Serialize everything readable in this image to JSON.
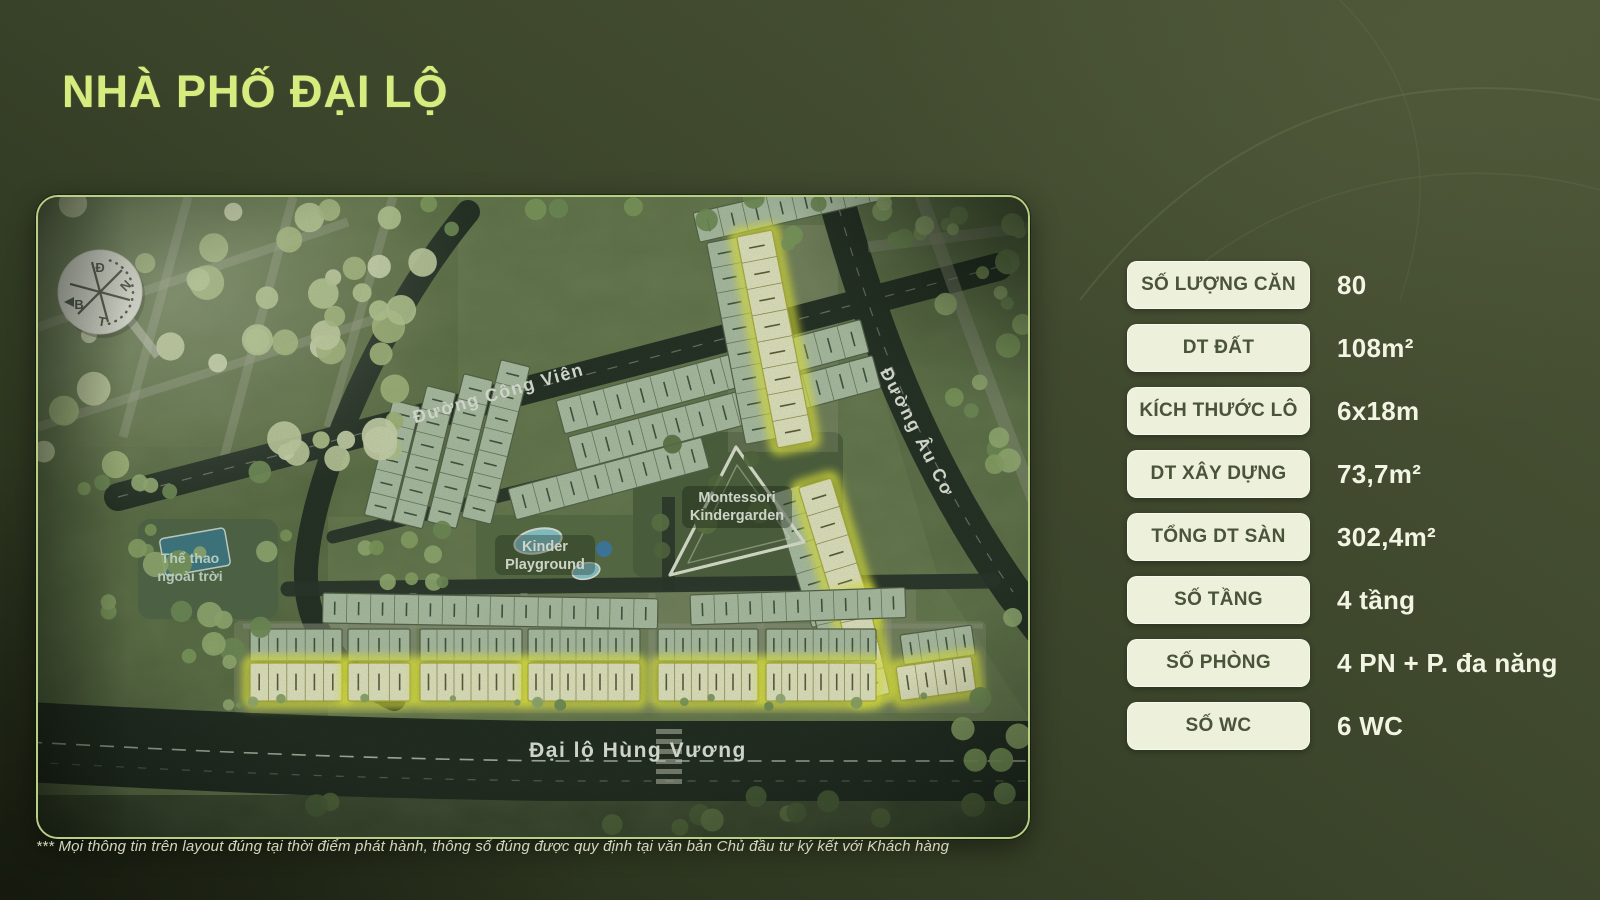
{
  "slide": {
    "title": "NHÀ PHỐ ĐẠI LỘ",
    "footnote": "*** Mọi thông tin trên layout đúng tại thời điểm phát hành, thông số đúng được quy định tại văn bản Chủ đầu tư ký kết với Khách hàng"
  },
  "specs": {
    "rows": [
      {
        "label": "SỐ LƯỢNG CĂN",
        "value": "80"
      },
      {
        "label": "DT ĐẤT",
        "value": "108m²"
      },
      {
        "label": "KÍCH THƯỚC LÔ",
        "value": "6x18m"
      },
      {
        "label": "DT XÂY DỰNG",
        "value": "73,7m²"
      },
      {
        "label": "TỔNG DT SÀN",
        "value": "302,4m²"
      },
      {
        "label": "SỐ TẦNG",
        "value": "4 tầng"
      },
      {
        "label": "SỐ PHÒNG",
        "value": "4 PN  + P. đa năng"
      },
      {
        "label": "SỐ WC",
        "value": "6 WC"
      }
    ]
  },
  "map": {
    "roads": {
      "cong_vien": "Đường Công Viên",
      "au_co": "Đường Âu Cơ",
      "hung_vuong": "Đại lộ Hùng Vương"
    },
    "landmarks": {
      "kindergarden_line1": "Montessori",
      "kindergarden_line2": "Kindergarden",
      "playground_line1": "Kinder",
      "playground_line2": "Playground",
      "sport_line1": "Thể thao",
      "sport_line2": "ngoài trời"
    },
    "compass": {
      "top": "Đ",
      "right": "N",
      "bottom": "T",
      "left": "B"
    }
  },
  "colors": {
    "title_accent": "#d6ec7f",
    "pill_bg": "#edf0da",
    "pill_text": "#4a5439",
    "value_text": "#f3f5e4",
    "highlight_lot": "#f2f83e"
  }
}
